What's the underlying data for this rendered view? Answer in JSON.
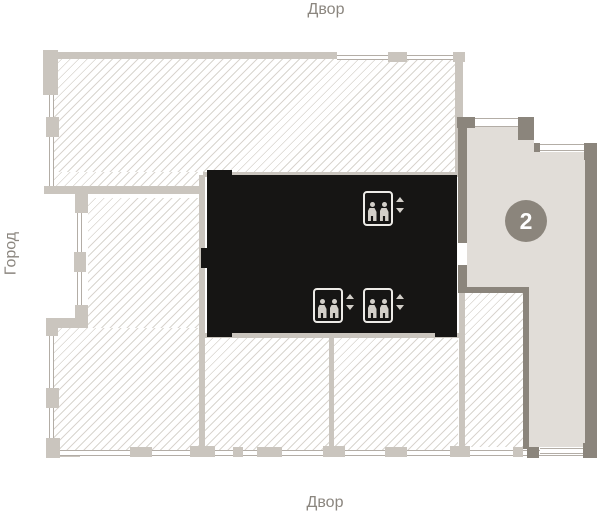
{
  "labels": {
    "top": "Двор",
    "bottom": "Двор",
    "left": "Город"
  },
  "unit": {
    "number": "2",
    "badge_color": "#8b857c"
  },
  "icons": {
    "elevator": "elevator-icon",
    "elevator_count": 3,
    "arrow_up": "arrow-up-icon",
    "arrow_down": "arrow-down-icon"
  },
  "colors": {
    "background": "#ffffff",
    "light_wall": "#cac5be",
    "dark_wall": "#8b857c",
    "unit_floor": "#e1ddd8",
    "core": "#161514",
    "hatch_line": "#d9d5cf",
    "window_line": "#b3ada6",
    "label_text": "#8b867f",
    "icon": "#d3cfc9"
  }
}
